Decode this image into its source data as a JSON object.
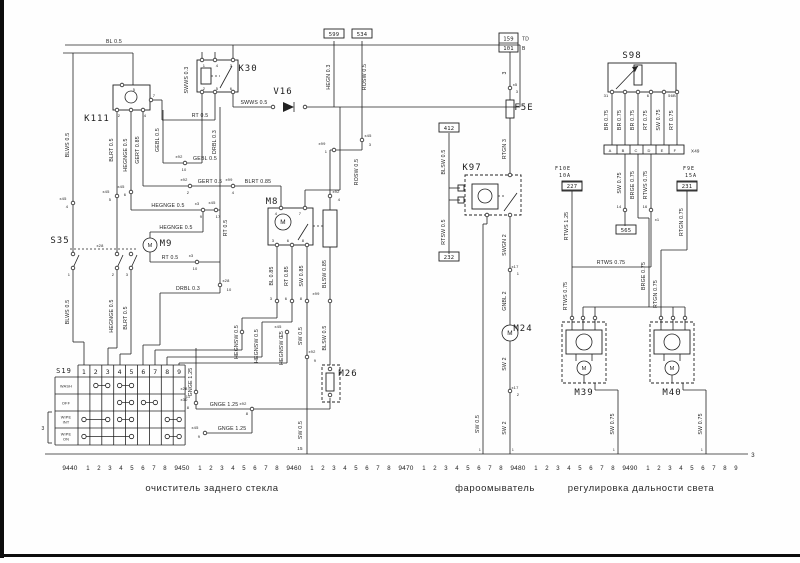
{
  "captions": {
    "left": "очиститель заднего стекла",
    "center": "фароомыватель",
    "right": "регулировка дальности света"
  },
  "scale": {
    "decades": [
      "9440",
      "9450",
      "9460",
      "9470",
      "9480",
      "9490"
    ],
    "minors": [
      "1",
      "2",
      "3",
      "4",
      "5",
      "6",
      "7",
      "8"
    ],
    "tail_minors": [
      "1",
      "2",
      "3",
      "4",
      "5",
      "6",
      "7",
      "8",
      "9"
    ],
    "end_mark": "3",
    "track_marks": [
      {
        "t": "15",
        "x": 300,
        "y": 450,
        "fs": 4.5
      },
      {
        "t": "1",
        "x": 480,
        "y": 451,
        "fs": 3.5
      },
      {
        "t": "1",
        "x": 513,
        "y": 451,
        "fs": 3.5
      },
      {
        "t": "1",
        "x": 614,
        "y": 451,
        "fs": 3.5
      },
      {
        "t": "1",
        "x": 702,
        "y": 451,
        "fs": 3.5
      }
    ]
  },
  "components": [
    {
      "t": "K111",
      "x": 97,
      "y": 121
    },
    {
      "t": "K30",
      "x": 248,
      "y": 71
    },
    {
      "t": "V16",
      "x": 283,
      "y": 94
    },
    {
      "t": "S35",
      "x": 60,
      "y": 243
    },
    {
      "t": "M9",
      "x": 166,
      "y": 246
    },
    {
      "t": "M8",
      "x": 272,
      "y": 204
    },
    {
      "t": "M26",
      "x": 348,
      "y": 376
    },
    {
      "t": "S19",
      "x": 64,
      "y": 373,
      "fs": 7
    },
    {
      "t": "K97",
      "x": 472,
      "y": 170
    },
    {
      "t": "F5E",
      "x": 524,
      "y": 110
    },
    {
      "t": "M24",
      "x": 523,
      "y": 331
    },
    {
      "t": "S98",
      "x": 632,
      "y": 58
    },
    {
      "t": "M39",
      "x": 584,
      "y": 395
    },
    {
      "t": "M40",
      "x": 672,
      "y": 395
    },
    {
      "t": "F10E",
      "x": 563,
      "y": 170,
      "fs": 5
    },
    {
      "t": "10A",
      "x": 565,
      "y": 177,
      "fs": 5
    },
    {
      "t": "F9E",
      "x": 689,
      "y": 170,
      "fs": 5
    },
    {
      "t": "15A",
      "x": 691,
      "y": 177,
      "fs": 5
    }
  ],
  "ref_boxes": [
    {
      "t": "599",
      "x": 334,
      "y": 35
    },
    {
      "t": "534",
      "x": 362,
      "y": 35
    },
    {
      "t": "412",
      "x": 449,
      "y": 129
    },
    {
      "t": "232",
      "x": 449,
      "y": 258
    },
    {
      "t": "227",
      "x": 572,
      "y": 187
    },
    {
      "t": "231",
      "x": 687,
      "y": 187
    },
    {
      "t": "565",
      "x": 626,
      "y": 231
    }
  ],
  "junction_box": {
    "rows": [
      "159",
      "101"
    ],
    "sides": [
      "TD",
      "B"
    ]
  },
  "wire_labels": [
    {
      "t": "BL 0.5",
      "x": 114,
      "y": 43
    },
    {
      "t": "SWWS 0.3",
      "x": 188,
      "y": 80,
      "v": 1
    },
    {
      "t": "SWWS 0.5",
      "x": 254,
      "y": 104
    },
    {
      "t": "RT 0.5",
      "x": 200,
      "y": 117
    },
    {
      "t": "HEGN 0.3",
      "x": 330,
      "y": 77,
      "v": 1
    },
    {
      "t": "ROSW 0.5",
      "x": 366,
      "y": 77,
      "v": 1
    },
    {
      "t": "ROSW 0.5",
      "x": 358,
      "y": 172,
      "v": 1
    },
    {
      "t": "BLWS 0.5",
      "x": 69,
      "y": 145,
      "v": 1
    },
    {
      "t": "BLRT 0.5",
      "x": 113,
      "y": 150,
      "v": 1
    },
    {
      "t": "HEGNGE 0.5",
      "x": 127,
      "y": 155,
      "v": 1
    },
    {
      "t": "GERT 0.85",
      "x": 139,
      "y": 150,
      "v": 1
    },
    {
      "t": "GEBL 0.5",
      "x": 159,
      "y": 140,
      "v": 1
    },
    {
      "t": "DRBL 0.3",
      "x": 216,
      "y": 142,
      "v": 1
    },
    {
      "t": "GEBL 0.5",
      "x": 205,
      "y": 160
    },
    {
      "t": "GERT 0.5",
      "x": 210,
      "y": 183
    },
    {
      "t": "BLRT 0.85",
      "x": 258,
      "y": 183
    },
    {
      "t": "HEGNGE 0.5",
      "x": 168,
      "y": 207
    },
    {
      "t": "HEGNGE 0.5",
      "x": 176,
      "y": 229
    },
    {
      "t": "RT 0.5",
      "x": 170,
      "y": 259
    },
    {
      "t": "RT 0.5",
      "x": 227,
      "y": 228,
      "v": 1
    },
    {
      "t": "DRBL 0.3",
      "x": 188,
      "y": 290
    },
    {
      "t": "BLWS 0.5",
      "x": 69,
      "y": 312,
      "v": 1
    },
    {
      "t": "HEGNGE 0.5",
      "x": 113,
      "y": 316,
      "v": 1
    },
    {
      "t": "BLRT 0.5",
      "x": 127,
      "y": 318,
      "v": 1
    },
    {
      "t": "GNGE 1.25",
      "x": 192,
      "y": 382,
      "v": 1
    },
    {
      "t": "GNGE 1.25",
      "x": 224,
      "y": 406
    },
    {
      "t": "GNGE 1.25",
      "x": 232,
      "y": 430
    },
    {
      "t": "BL 0.85",
      "x": 273,
      "y": 276,
      "v": 1
    },
    {
      "t": "RT 0.85",
      "x": 288,
      "y": 276,
      "v": 1
    },
    {
      "t": "SW 0.85",
      "x": 303,
      "y": 276,
      "v": 1
    },
    {
      "t": "BLSW 0.85",
      "x": 326,
      "y": 274,
      "v": 1
    },
    {
      "t": "SW 0.5",
      "x": 302,
      "y": 336,
      "v": 1
    },
    {
      "t": "SW 0.5",
      "x": 302,
      "y": 430,
      "v": 1
    },
    {
      "t": "BLSW 0.5",
      "x": 326,
      "y": 338,
      "v": 1
    },
    {
      "t": "HEGNSW 0.5",
      "x": 238,
      "y": 342,
      "v": 1
    },
    {
      "t": "HEGNSW 0.5",
      "x": 258,
      "y": 346,
      "v": 1
    },
    {
      "t": "HEGNSW 0.5",
      "x": 283,
      "y": 348,
      "v": 1
    },
    {
      "t": "BLSW 0.5",
      "x": 445,
      "y": 162,
      "v": 1
    },
    {
      "t": "RTSW 0.5",
      "x": 445,
      "y": 232,
      "v": 1
    },
    {
      "t": "3",
      "x": 506,
      "y": 73,
      "v": 1
    },
    {
      "t": "RTGN 3",
      "x": 506,
      "y": 149,
      "v": 1
    },
    {
      "t": "SWGN 2",
      "x": 506,
      "y": 245,
      "v": 1
    },
    {
      "t": "GNBL 2",
      "x": 506,
      "y": 301,
      "v": 1
    },
    {
      "t": "SW 2",
      "x": 506,
      "y": 364,
      "v": 1
    },
    {
      "t": "SW 2",
      "x": 506,
      "y": 428,
      "v": 1
    },
    {
      "t": "SW 0.5",
      "x": 479,
      "y": 424,
      "v": 1
    },
    {
      "t": "BR 0.75",
      "x": 608,
      "y": 120,
      "v": 1
    },
    {
      "t": "BR 0.75",
      "x": 621,
      "y": 120,
      "v": 1
    },
    {
      "t": "BR 0.75",
      "x": 634,
      "y": 120,
      "v": 1
    },
    {
      "t": "RT 0.75",
      "x": 647,
      "y": 120,
      "v": 1
    },
    {
      "t": "SW 0.75",
      "x": 660,
      "y": 120,
      "v": 1
    },
    {
      "t": "RT 0.75",
      "x": 673,
      "y": 120,
      "v": 1
    },
    {
      "t": "SW 0.75",
      "x": 621,
      "y": 183,
      "v": 1
    },
    {
      "t": "BRGE 0.75",
      "x": 634,
      "y": 185,
      "v": 1
    },
    {
      "t": "RTWS 0.75",
      "x": 647,
      "y": 185,
      "v": 1
    },
    {
      "t": "RTWS 1.25",
      "x": 568,
      "y": 226,
      "v": 1
    },
    {
      "t": "RTWS 0.75",
      "x": 611,
      "y": 264
    },
    {
      "t": "RTWS 0.75",
      "x": 567,
      "y": 296,
      "v": 1
    },
    {
      "t": "BRGE 0.75",
      "x": 645,
      "y": 276,
      "v": 1
    },
    {
      "t": "RTGN 0.75",
      "x": 683,
      "y": 222,
      "v": 1
    },
    {
      "t": "RTGN 0.75",
      "x": 657,
      "y": 294,
      "v": 1
    },
    {
      "t": "SW 0.75",
      "x": 614,
      "y": 424,
      "v": 1
    },
    {
      "t": "SW 0.75",
      "x": 702,
      "y": 424,
      "v": 1
    }
  ],
  "pin_labels": [
    {
      "t": "x45",
      "x": 63,
      "y": 200
    },
    {
      "t": "4",
      "x": 67,
      "y": 208
    },
    {
      "t": "x45",
      "x": 106,
      "y": 193
    },
    {
      "t": "5",
      "x": 110,
      "y": 201
    },
    {
      "t": "x45",
      "x": 121,
      "y": 188
    },
    {
      "t": "6",
      "x": 125,
      "y": 196
    },
    {
      "t": "x92",
      "x": 179,
      "y": 158
    },
    {
      "t": "10",
      "x": 184,
      "y": 171
    },
    {
      "t": "x92",
      "x": 184,
      "y": 181
    },
    {
      "t": "2",
      "x": 188,
      "y": 194
    },
    {
      "t": "x99",
      "x": 229,
      "y": 181
    },
    {
      "t": "4",
      "x": 233,
      "y": 194
    },
    {
      "t": "x3",
      "x": 197,
      "y": 205
    },
    {
      "t": "9",
      "x": 201,
      "y": 218
    },
    {
      "t": "x45",
      "x": 212,
      "y": 204
    },
    {
      "t": "17",
      "x": 218,
      "y": 218
    },
    {
      "t": "x3",
      "x": 191,
      "y": 257
    },
    {
      "t": "10",
      "x": 195,
      "y": 270
    },
    {
      "t": "x28",
      "x": 226,
      "y": 282
    },
    {
      "t": "10",
      "x": 229,
      "y": 291
    },
    {
      "t": "x28",
      "x": 100,
      "y": 247
    },
    {
      "t": "1",
      "x": 69,
      "y": 276
    },
    {
      "t": "2",
      "x": 113,
      "y": 276
    },
    {
      "t": "3",
      "x": 127,
      "y": 276
    },
    {
      "t": "x45",
      "x": 368,
      "y": 137
    },
    {
      "t": "3",
      "x": 370,
      "y": 146
    },
    {
      "t": "x99",
      "x": 322,
      "y": 145
    },
    {
      "t": "1",
      "x": 326,
      "y": 153
    },
    {
      "t": "x92",
      "x": 336,
      "y": 193
    },
    {
      "t": "4",
      "x": 339,
      "y": 201
    },
    {
      "t": "x99",
      "x": 316,
      "y": 295
    },
    {
      "t": "4",
      "x": 276,
      "y": 215
    },
    {
      "t": "7",
      "x": 300,
      "y": 215
    },
    {
      "t": "3",
      "x": 273,
      "y": 242
    },
    {
      "t": "6",
      "x": 288,
      "y": 242
    },
    {
      "t": "8",
      "x": 303,
      "y": 242
    },
    {
      "t": "3",
      "x": 271,
      "y": 300
    },
    {
      "t": "6",
      "x": 286,
      "y": 300
    },
    {
      "t": "8",
      "x": 301,
      "y": 300
    },
    {
      "t": "x92",
      "x": 312,
      "y": 353
    },
    {
      "t": "9",
      "x": 315,
      "y": 362
    },
    {
      "t": "x45",
      "x": 278,
      "y": 328
    },
    {
      "t": "18",
      "x": 281,
      "y": 337
    },
    {
      "t": "x92",
      "x": 243,
      "y": 405
    },
    {
      "t": "8",
      "x": 247,
      "y": 415
    },
    {
      "t": "x28",
      "x": 184,
      "y": 390
    },
    {
      "t": "11",
      "x": 188,
      "y": 398
    },
    {
      "t": "x30",
      "x": 184,
      "y": 401
    },
    {
      "t": "8",
      "x": 188,
      "y": 409
    },
    {
      "t": "x45",
      "x": 195,
      "y": 429
    },
    {
      "t": "9",
      "x": 199,
      "y": 438
    },
    {
      "t": "x5",
      "x": 515,
      "y": 86
    },
    {
      "t": "3",
      "x": 517,
      "y": 93
    },
    {
      "t": "x17",
      "x": 515,
      "y": 268
    },
    {
      "t": "1",
      "x": 518,
      "y": 275
    },
    {
      "t": "x17",
      "x": 515,
      "y": 389
    },
    {
      "t": "2",
      "x": 518,
      "y": 396
    },
    {
      "t": "14",
      "x": 619,
      "y": 208
    },
    {
      "t": "16",
      "x": 645,
      "y": 208
    },
    {
      "t": "x1",
      "x": 657,
      "y": 221
    },
    {
      "t": "31",
      "x": 606,
      "y": 97
    },
    {
      "t": "6",
      "x": 648,
      "y": 97
    },
    {
      "t": "56B",
      "x": 672,
      "y": 97
    },
    {
      "t": "1",
      "x": 204,
      "y": 67
    },
    {
      "t": "4",
      "x": 217,
      "y": 67
    },
    {
      "t": "3",
      "x": 231,
      "y": 67
    },
    {
      "t": "2",
      "x": 204,
      "y": 90
    },
    {
      "t": "5",
      "x": 217,
      "y": 90
    },
    {
      "t": "6",
      "x": 231,
      "y": 90
    },
    {
      "t": "5",
      "x": 134,
      "y": 91
    },
    {
      "t": "2",
      "x": 119,
      "y": 117
    },
    {
      "t": "4",
      "x": 145,
      "y": 117
    },
    {
      "t": "7",
      "x": 154,
      "y": 97
    }
  ],
  "s19": {
    "id": "S19",
    "columns": [
      "1",
      "2",
      "3",
      "4",
      "5",
      "6",
      "7",
      "8",
      "9"
    ],
    "rows": [
      {
        "label": "WASH",
        "contacts": [
          [
            2,
            3
          ],
          [
            4,
            5
          ]
        ]
      },
      {
        "label": "OFF",
        "contacts": [
          [
            4,
            5
          ],
          [
            6,
            7
          ]
        ]
      },
      {
        "label": "WIPE INT",
        "contacts": [
          [
            1,
            3
          ],
          [
            4,
            5
          ],
          [
            8,
            9
          ]
        ]
      },
      {
        "label": "WIPE ON",
        "contacts": [
          [
            1,
            5
          ],
          [
            8,
            9
          ]
        ]
      }
    ],
    "side_mark": "3"
  },
  "s98_strip": {
    "letters": [
      "A",
      "B",
      "C",
      "D",
      "E",
      "F"
    ],
    "label": "X49"
  },
  "motor_letter": "M"
}
